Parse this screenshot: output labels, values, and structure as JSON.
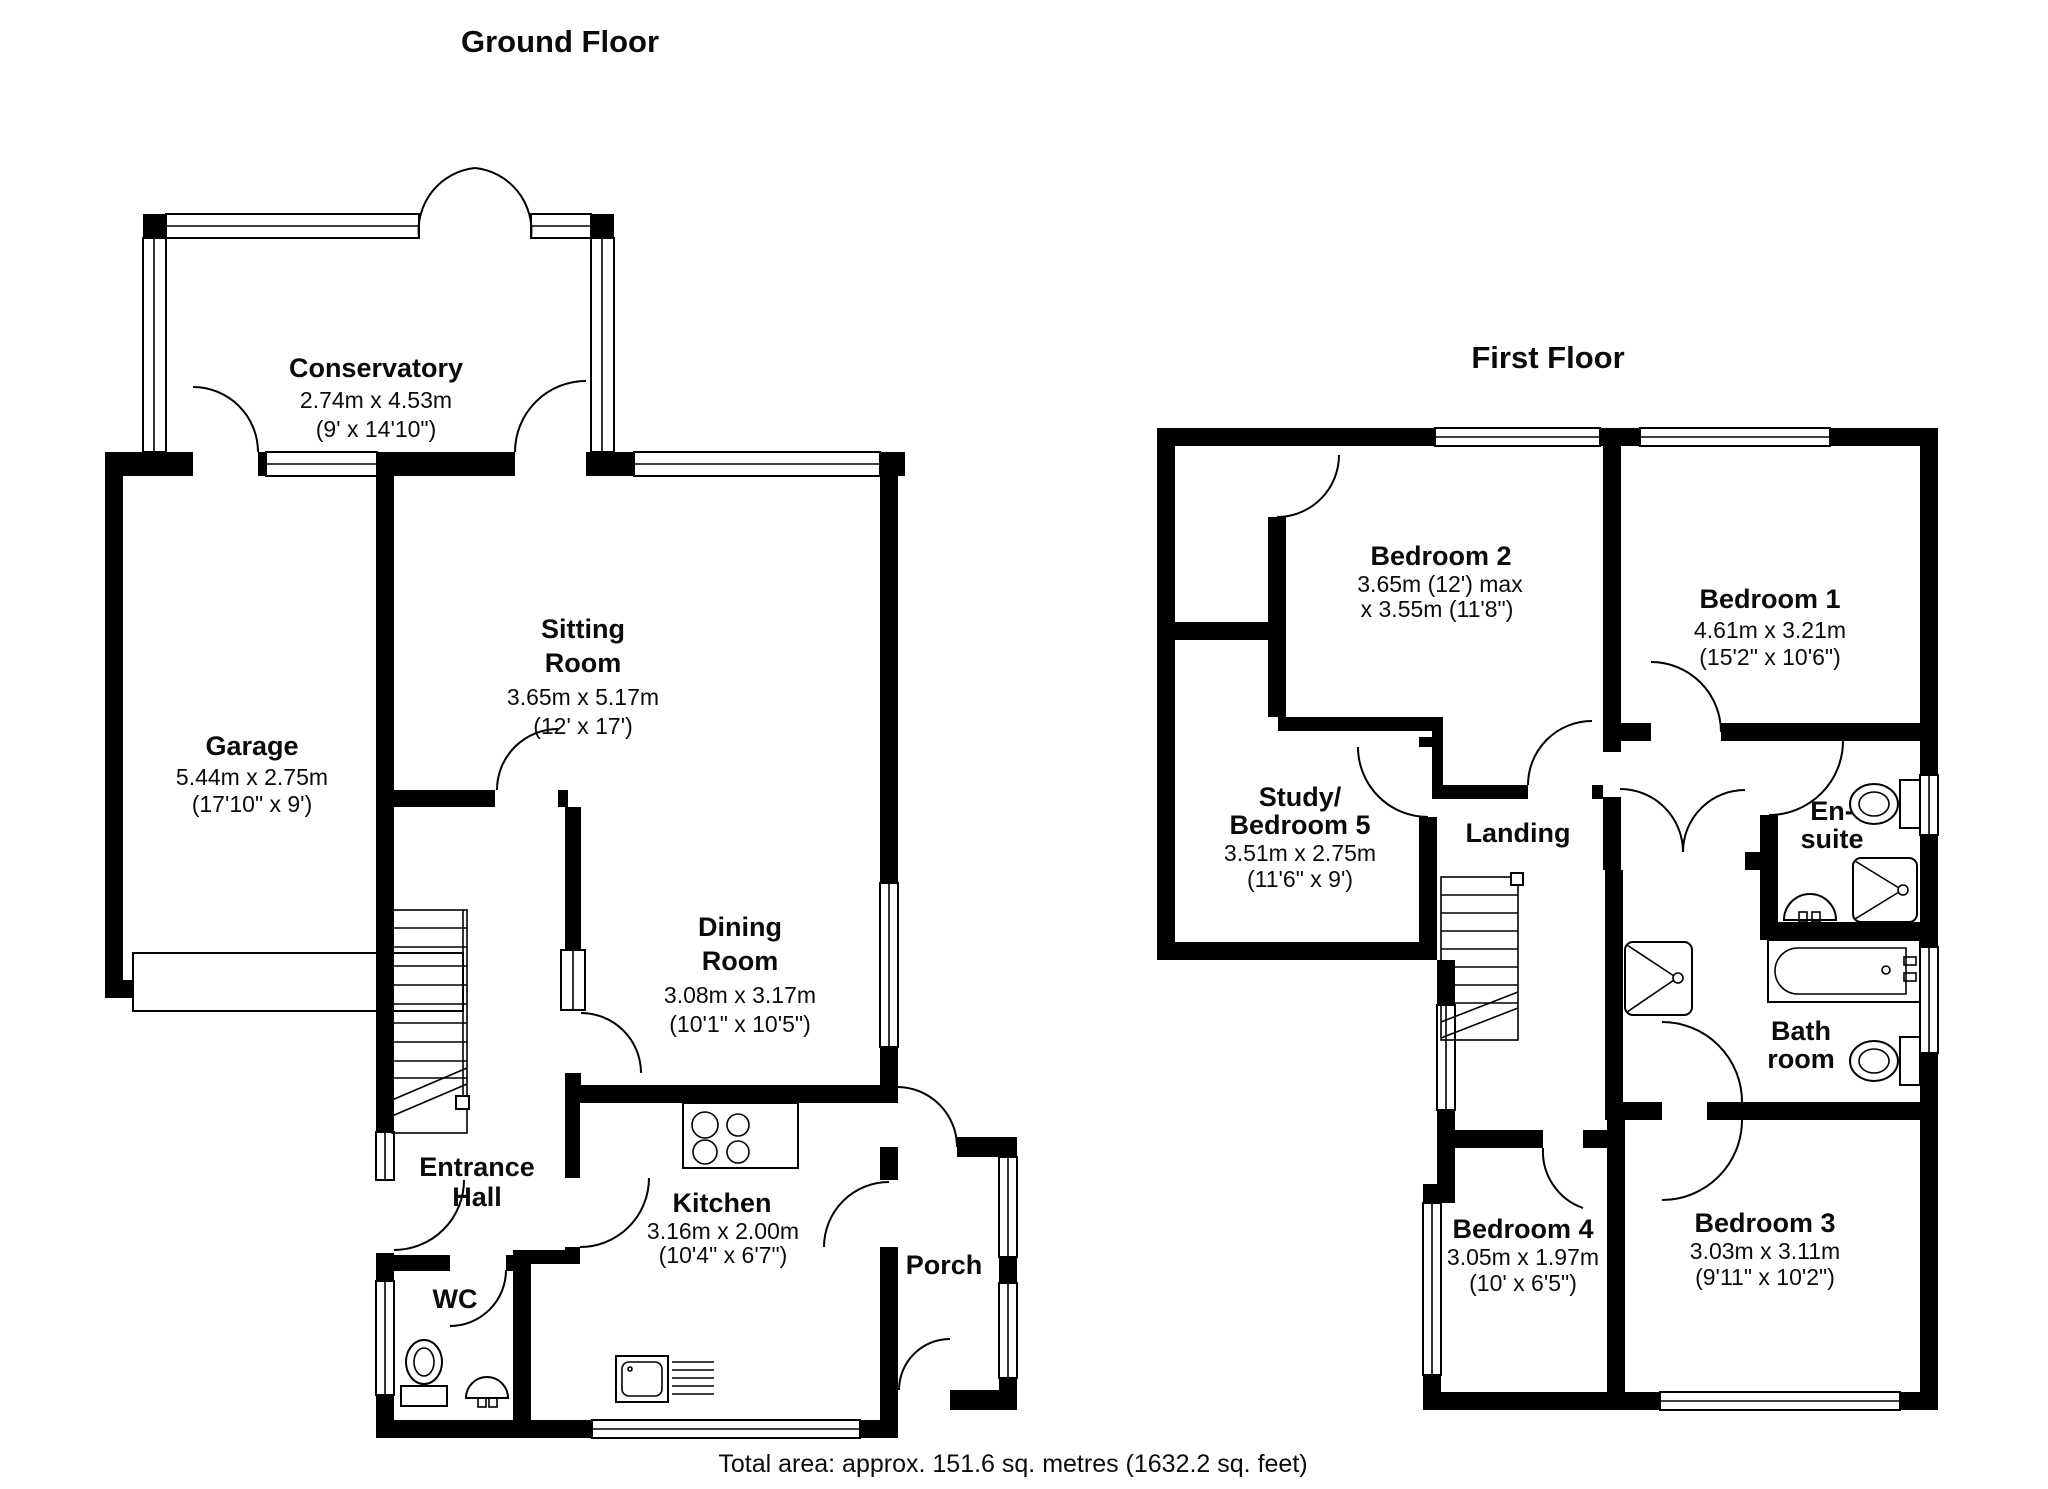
{
  "ground_floor": {
    "title": "Ground Floor",
    "rooms": {
      "conservatory": {
        "lines": [
          "Conservatory",
          "2.74m x 4.53m",
          "(9' x 14'10\")"
        ]
      },
      "garage": {
        "lines": [
          "Garage",
          "5.44m x 2.75m",
          "(17'10\" x 9')"
        ]
      },
      "sitting_room": {
        "lines": [
          "Sitting",
          "Room",
          "3.65m x 5.17m",
          "(12' x 17')"
        ]
      },
      "dining_room": {
        "lines": [
          "Dining",
          "Room",
          "3.08m x 3.17m",
          "(10'1\" x 10'5\")"
        ]
      },
      "entrance_hall": {
        "lines": [
          "Entrance",
          "Hall"
        ]
      },
      "wc": {
        "lines": [
          "WC"
        ]
      },
      "kitchen": {
        "lines": [
          "Kitchen",
          "3.16m x 2.00m",
          "(10'4\" x 6'7\")"
        ]
      },
      "porch": {
        "lines": [
          "Porch"
        ]
      }
    }
  },
  "first_floor": {
    "title": "First Floor",
    "rooms": {
      "bedroom2": {
        "lines": [
          "Bedroom 2",
          "3.65m (12') max",
          "x 3.55m (11'8\")"
        ]
      },
      "bedroom1": {
        "lines": [
          "Bedroom 1",
          "4.61m x 3.21m",
          "(15'2\" x 10'6\")"
        ]
      },
      "study_bedroom5": {
        "lines": [
          "Study/",
          "Bedroom 5",
          "3.51m x 2.75m",
          "(11'6\" x 9')"
        ]
      },
      "landing": {
        "lines": [
          "Landing"
        ]
      },
      "ensuite": {
        "lines": [
          "En-",
          "suite"
        ]
      },
      "bathroom": {
        "lines": [
          "Bath",
          "room"
        ]
      },
      "bedroom4": {
        "lines": [
          "Bedroom 4",
          "3.05m x 1.97m",
          "(10' x 6'5\")"
        ]
      },
      "bedroom3": {
        "lines": [
          "Bedroom 3",
          "3.03m x 3.11m",
          "(9'11\" x 10'2\")"
        ]
      }
    }
  },
  "footer": {
    "total_area": "Total area: approx. 151.6 sq. metres (1632.2 sq. feet)"
  },
  "colors": {
    "wall": "#000000",
    "background": "#ffffff",
    "text": "#0b0b0b"
  }
}
